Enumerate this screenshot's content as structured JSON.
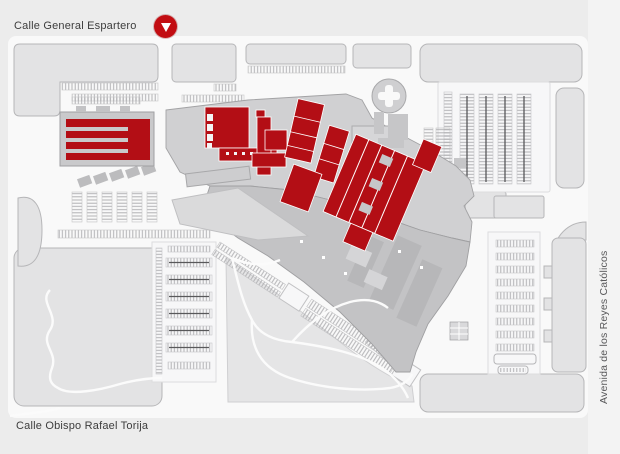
{
  "map": {
    "streets": {
      "top": "Calle General Espartero",
      "bottom": "Calle Obispo Rafael Torija",
      "right": "Avenida de los Reyes Católicos"
    },
    "marker": {
      "icon": "location-marker-down-triangle",
      "color": "#c20d12"
    },
    "colors": {
      "background": "#ececec",
      "road": "#f9f9f9",
      "block_fill": "#e3e3e4",
      "block_stroke": "#b6b6b8",
      "parking_base": "#f7f7f8",
      "hatch_line": "#b2b2b4",
      "lane_line": "#58585a",
      "mall_light": "#d0d0d2",
      "mall_mid": "#c9c9cb",
      "mall_dark": "#c3c3c5",
      "highlight_red": "#b30e15",
      "label_color": "#3d3d3d",
      "side_label_color": "#58585a",
      "side_strip": "#f3f3f3"
    }
  }
}
